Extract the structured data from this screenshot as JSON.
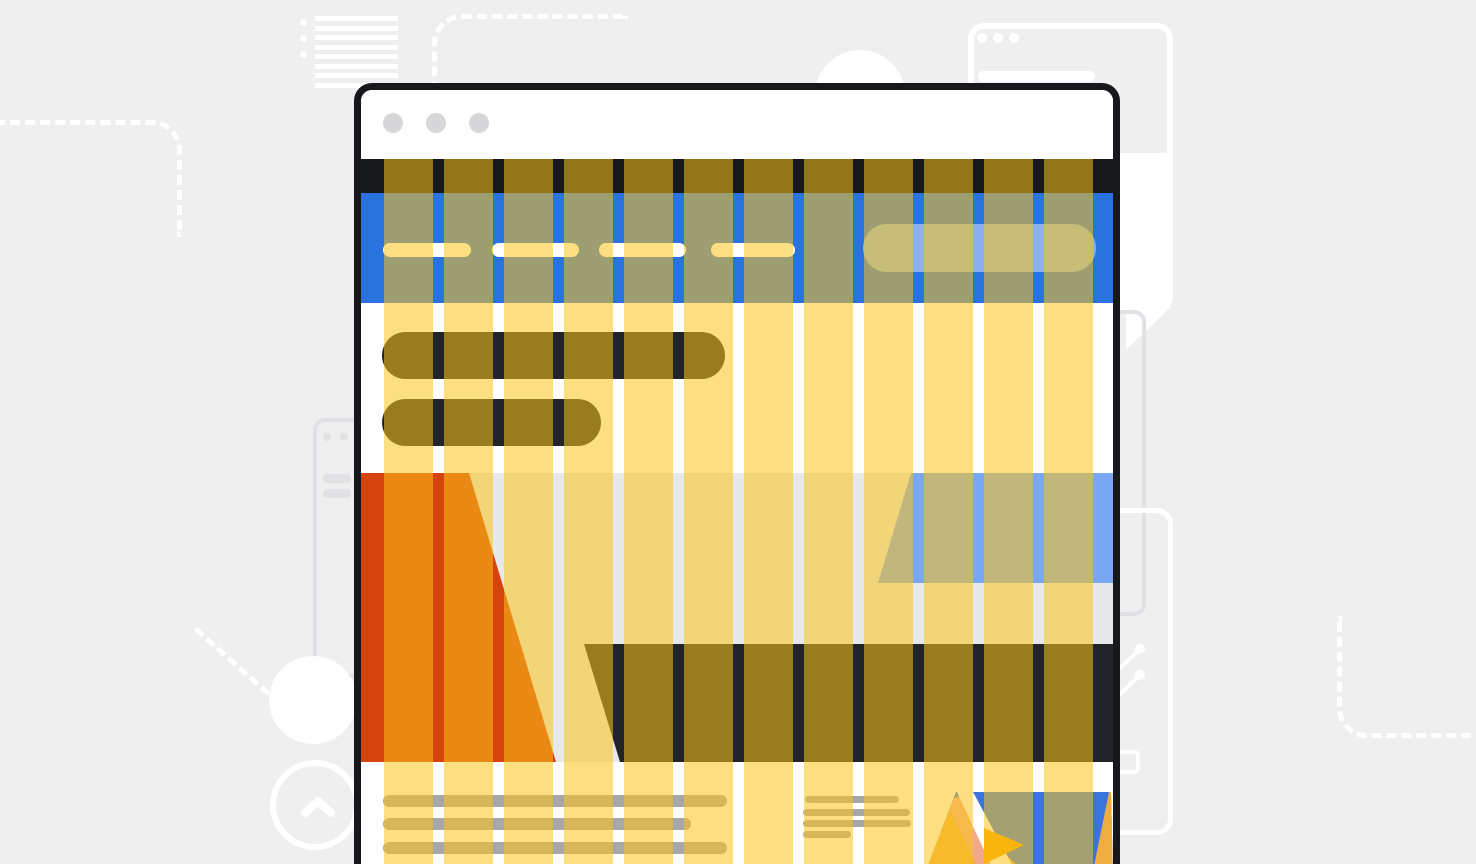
{
  "illustration": {
    "subject": "browser-window-wireframe-with-12-column-grid-overlay",
    "visible_text": ""
  },
  "palette": {
    "page_bg": "#efefef",
    "window_border": "#17181b",
    "titlebar_bg": "#ffffff",
    "toolbar_strip": "#17181b",
    "hero_blue": "#2a72de",
    "skeleton_dark": "#212529",
    "band_gray": "#e7e8ea",
    "accent_orange": "#d6430f",
    "accent_light_blue": "#7aa7f3",
    "overlay_rgba": "rgba(252,196,25,0.55)",
    "overlay_yellow": "#fcc419",
    "line_gray": "#a7a7a7",
    "thumb_sky": "#3b74dc",
    "thumb_gold": "#f0ad3f",
    "thumb_gold_dark": "#f59f00",
    "thumb_salmon": "#f2a88b",
    "decoration_white": "#ffffff",
    "decoration_gray": "#e0e1e4",
    "dot_gray": "#d7d7d9"
  },
  "browser_window": {
    "traffic_light_count": 3,
    "nav_pills": [
      {
        "x": 22,
        "width": 88
      },
      {
        "x": 131,
        "width": 87
      },
      {
        "x": 238,
        "width": 87
      },
      {
        "x": 350,
        "width": 84
      }
    ],
    "search_pill": {
      "x": 502,
      "y": 31,
      "width": 233,
      "height": 48
    },
    "headline_bars": [
      {
        "x": 21,
        "y": 242,
        "width": 343,
        "height": 47
      },
      {
        "x": 21,
        "y": 309,
        "width": 219,
        "height": 47
      }
    ],
    "paragraph_lines_left": [
      {
        "x": 22,
        "y": 705,
        "width": 344
      },
      {
        "x": 22,
        "y": 728,
        "width": 308
      },
      {
        "x": 22,
        "y": 752,
        "width": 344
      }
    ],
    "paragraph_lines_mid": [
      {
        "x": 444,
        "y": 706,
        "width": 94
      },
      {
        "x": 442,
        "y": 719,
        "width": 107
      },
      {
        "x": 442,
        "y": 730,
        "width": 108
      },
      {
        "x": 442,
        "y": 741,
        "width": 48
      }
    ]
  },
  "grid_overlay": {
    "columns": 12,
    "column_width": 49,
    "gutter_width": 11
  },
  "background_decorations": {
    "list_icon_lines": 8,
    "list_icon_dots": 3,
    "bubble_card_dots": 3,
    "left_card_dots": 2,
    "left_card_bars": 2
  }
}
